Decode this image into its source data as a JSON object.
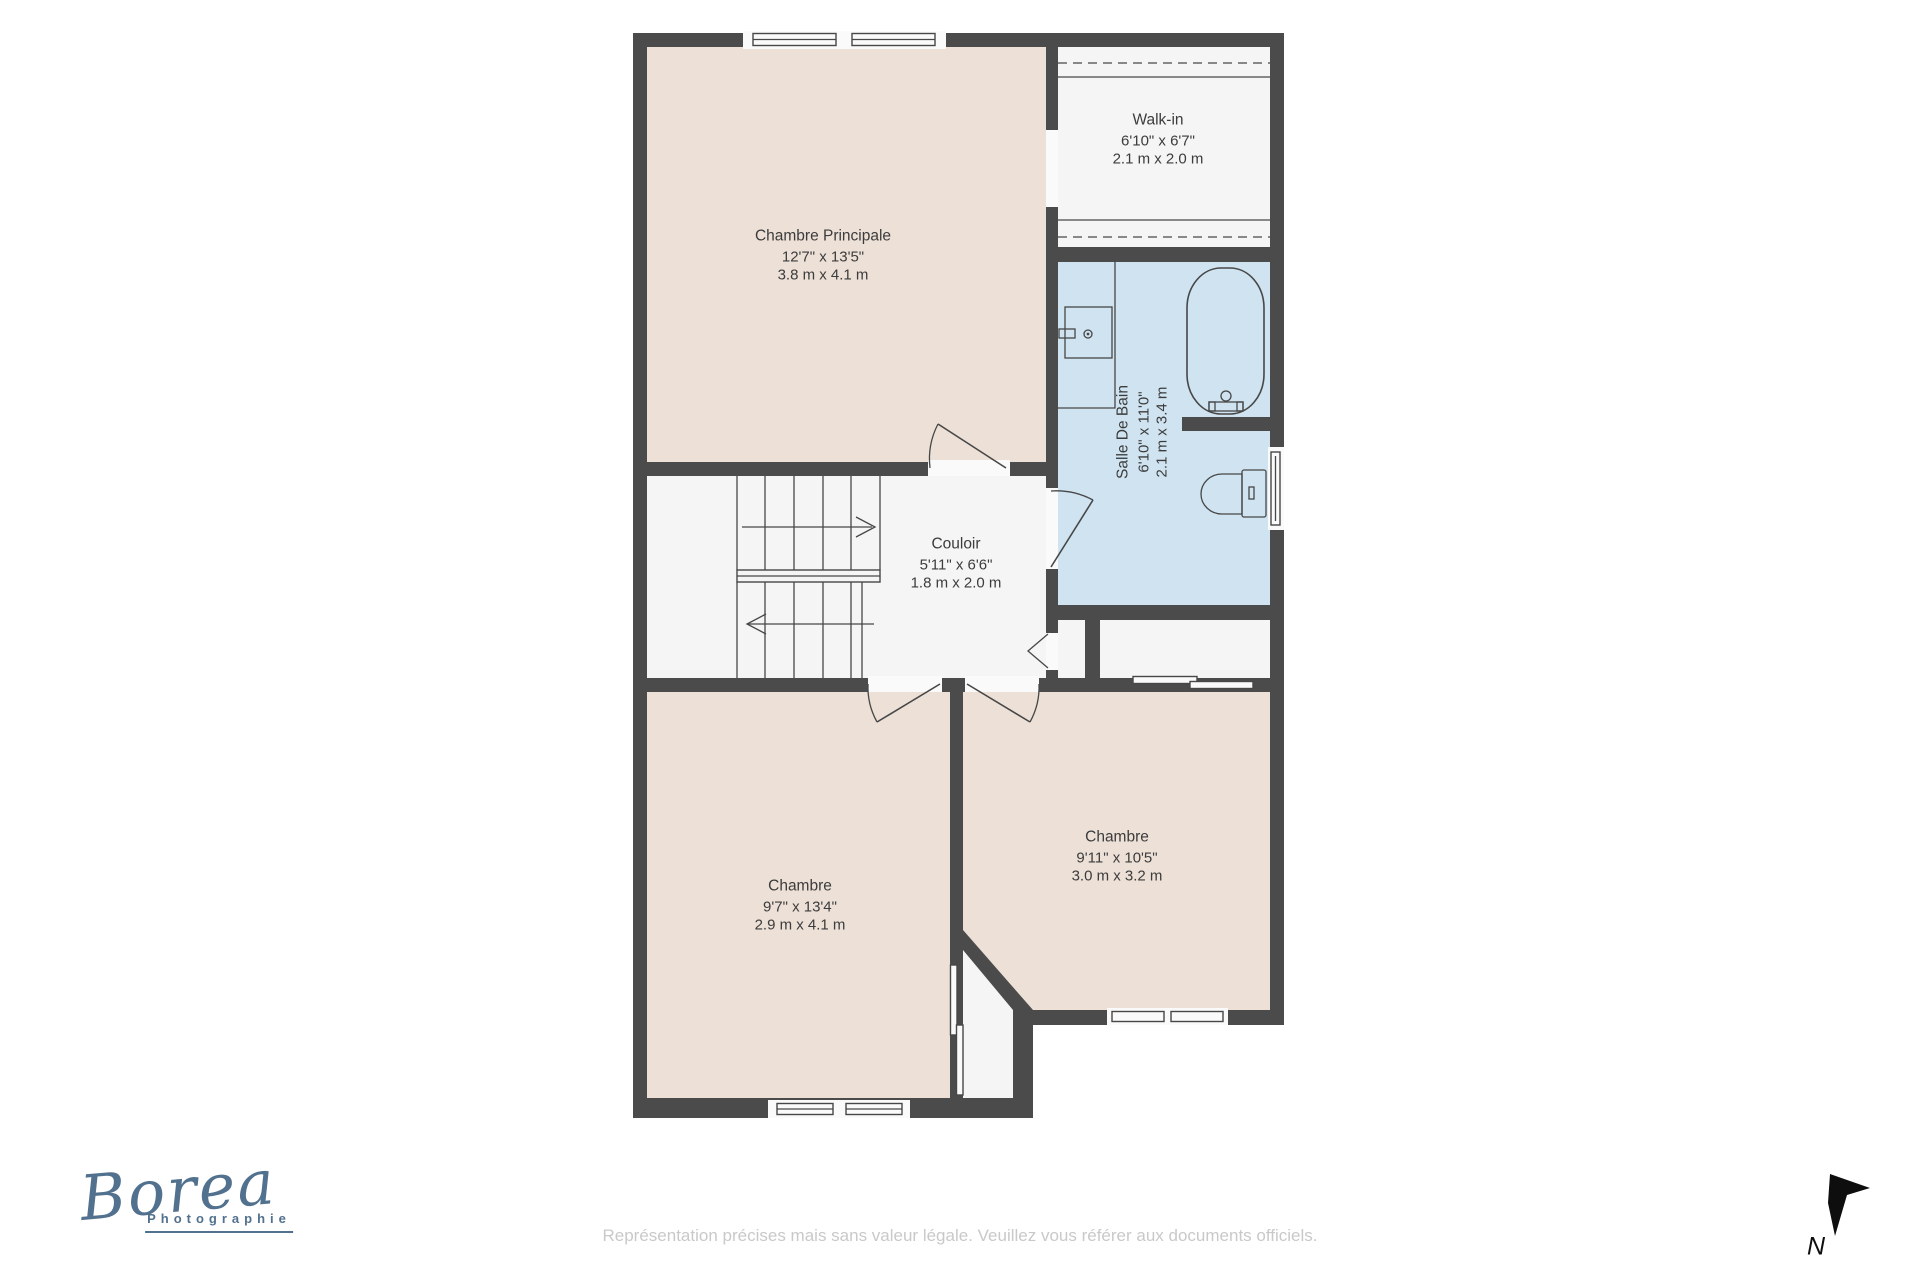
{
  "colors": {
    "wall": "#4b4b4b",
    "floor": "#ece0d7",
    "floor-accent": "#cfe3f1",
    "floor-light": "#f5f5f5",
    "window": "#fafafa",
    "line": "#474747",
    "text": "#3c3c3c",
    "logo": "#51718e",
    "muted": "#c9c9c9",
    "north": "#0e0e0e",
    "bg": "#ffffff"
  },
  "rooms": [
    {
      "name": "Chambre Principale",
      "imperial": "12'7\" x 13'5\"",
      "metric": "3.8 m x 4.1 m"
    },
    {
      "name": "Walk-in",
      "imperial": "6'10\" x 6'7\"",
      "metric": "2.1 m x 2.0 m"
    },
    {
      "name": "Salle De Bain",
      "imperial": "6'10\" x 11'0\"",
      "metric": "2.1 m x 3.4 m"
    },
    {
      "name": "Couloir",
      "imperial": "5'11\" x 6'6\"",
      "metric": "1.8 m x 2.0 m"
    },
    {
      "name": "Chambre",
      "imperial": "9'7\" x 13'4\"",
      "metric": "2.9 m x 4.1 m"
    },
    {
      "name": "Chambre",
      "imperial": "9'11\" x 10'5\"",
      "metric": "3.0 m x 3.2 m"
    }
  ],
  "logo": {
    "name": "Borea",
    "subtitle": "Photographie"
  },
  "compass": {
    "label": "N"
  },
  "footer": {
    "disclaimer": "Représentation précises mais sans valeur légale. Veuillez vous référer aux documents officiels."
  }
}
